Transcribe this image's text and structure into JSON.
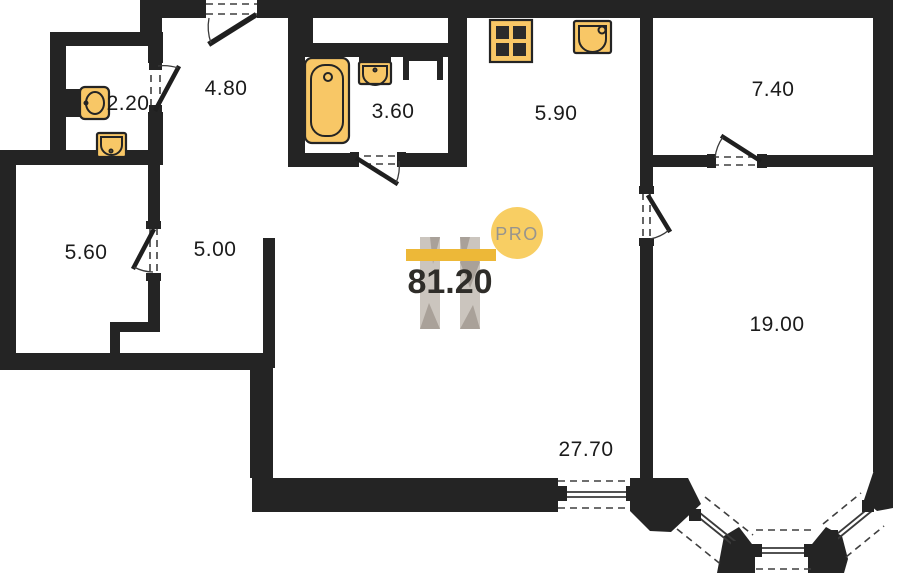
{
  "plan": {
    "total_area": "81.20",
    "pro_badge": "PRO",
    "rooms": {
      "wc": "2.20",
      "entry_hall": "4.80",
      "bathroom": "3.60",
      "kitchen": "5.90",
      "room_top_right": "7.40",
      "storage": "5.60",
      "hallway": "5.00",
      "bedroom": "19.00",
      "living_room": "27.70"
    },
    "fixtures": [
      "toilet-icon",
      "wc-washbasin-icon",
      "bathtub-icon",
      "bathroom-washbasin-icon",
      "stove-icon",
      "kitchen-sink-icon",
      "vent-shaft"
    ],
    "colors": {
      "wall": "#242424",
      "fixture_fill": "#f8c766",
      "logo_bar_yellow": "#edb838",
      "pro_circle_yellow": "#f8ce63",
      "pro_text_gray": "#97948e",
      "watermark_gray": "#cbc5be",
      "watermark_shade": "#a9a199",
      "label_black": "#1b1b1b",
      "total_black": "#2f2d29"
    }
  }
}
